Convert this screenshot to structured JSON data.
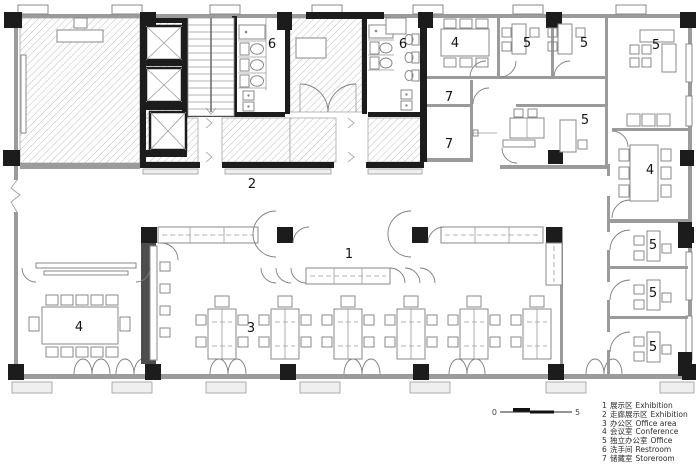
{
  "rooms": {
    "exhibition_hall": {
      "number": "1"
    },
    "corridor_exhibition": {
      "number": "2"
    },
    "office_area": {
      "number": "3"
    },
    "conference_left": {
      "number": "4"
    },
    "conference_top": {
      "number": "4"
    },
    "conference_right": {
      "number": "4"
    },
    "office_top_1": {
      "number": "5"
    },
    "office_top_2": {
      "number": "5"
    },
    "office_top_right": {
      "number": "5"
    },
    "office_mid": {
      "number": "5"
    },
    "office_stack_1": {
      "number": "5"
    },
    "office_stack_2": {
      "number": "5"
    },
    "office_stack_3": {
      "number": "5"
    },
    "restroom_1": {
      "number": "6"
    },
    "restroom_2": {
      "number": "6"
    },
    "storeroom_1": {
      "number": "7"
    },
    "storeroom_2": {
      "number": "7"
    }
  },
  "legend": {
    "items": [
      {
        "number": "1",
        "zh": "展示区",
        "en": "Exhibition"
      },
      {
        "number": "2",
        "zh": "走廊展示区",
        "en": "Exhibition"
      },
      {
        "number": "3",
        "zh": "办公区",
        "en": "Office area"
      },
      {
        "number": "4",
        "zh": "会议室",
        "en": "Conference"
      },
      {
        "number": "5",
        "zh": "独立办公室",
        "en": "Office"
      },
      {
        "number": "6",
        "zh": "洗手间",
        "en": "Restroom"
      },
      {
        "number": "7",
        "zh": "储藏室",
        "en": "Storeroom"
      }
    ]
  },
  "scale_bar": {
    "start": "0",
    "end": "5"
  },
  "colors": {
    "wall": "#1c1c1c",
    "wall_gray": "#9b9b9b",
    "hatch": "#b8b8b8"
  }
}
